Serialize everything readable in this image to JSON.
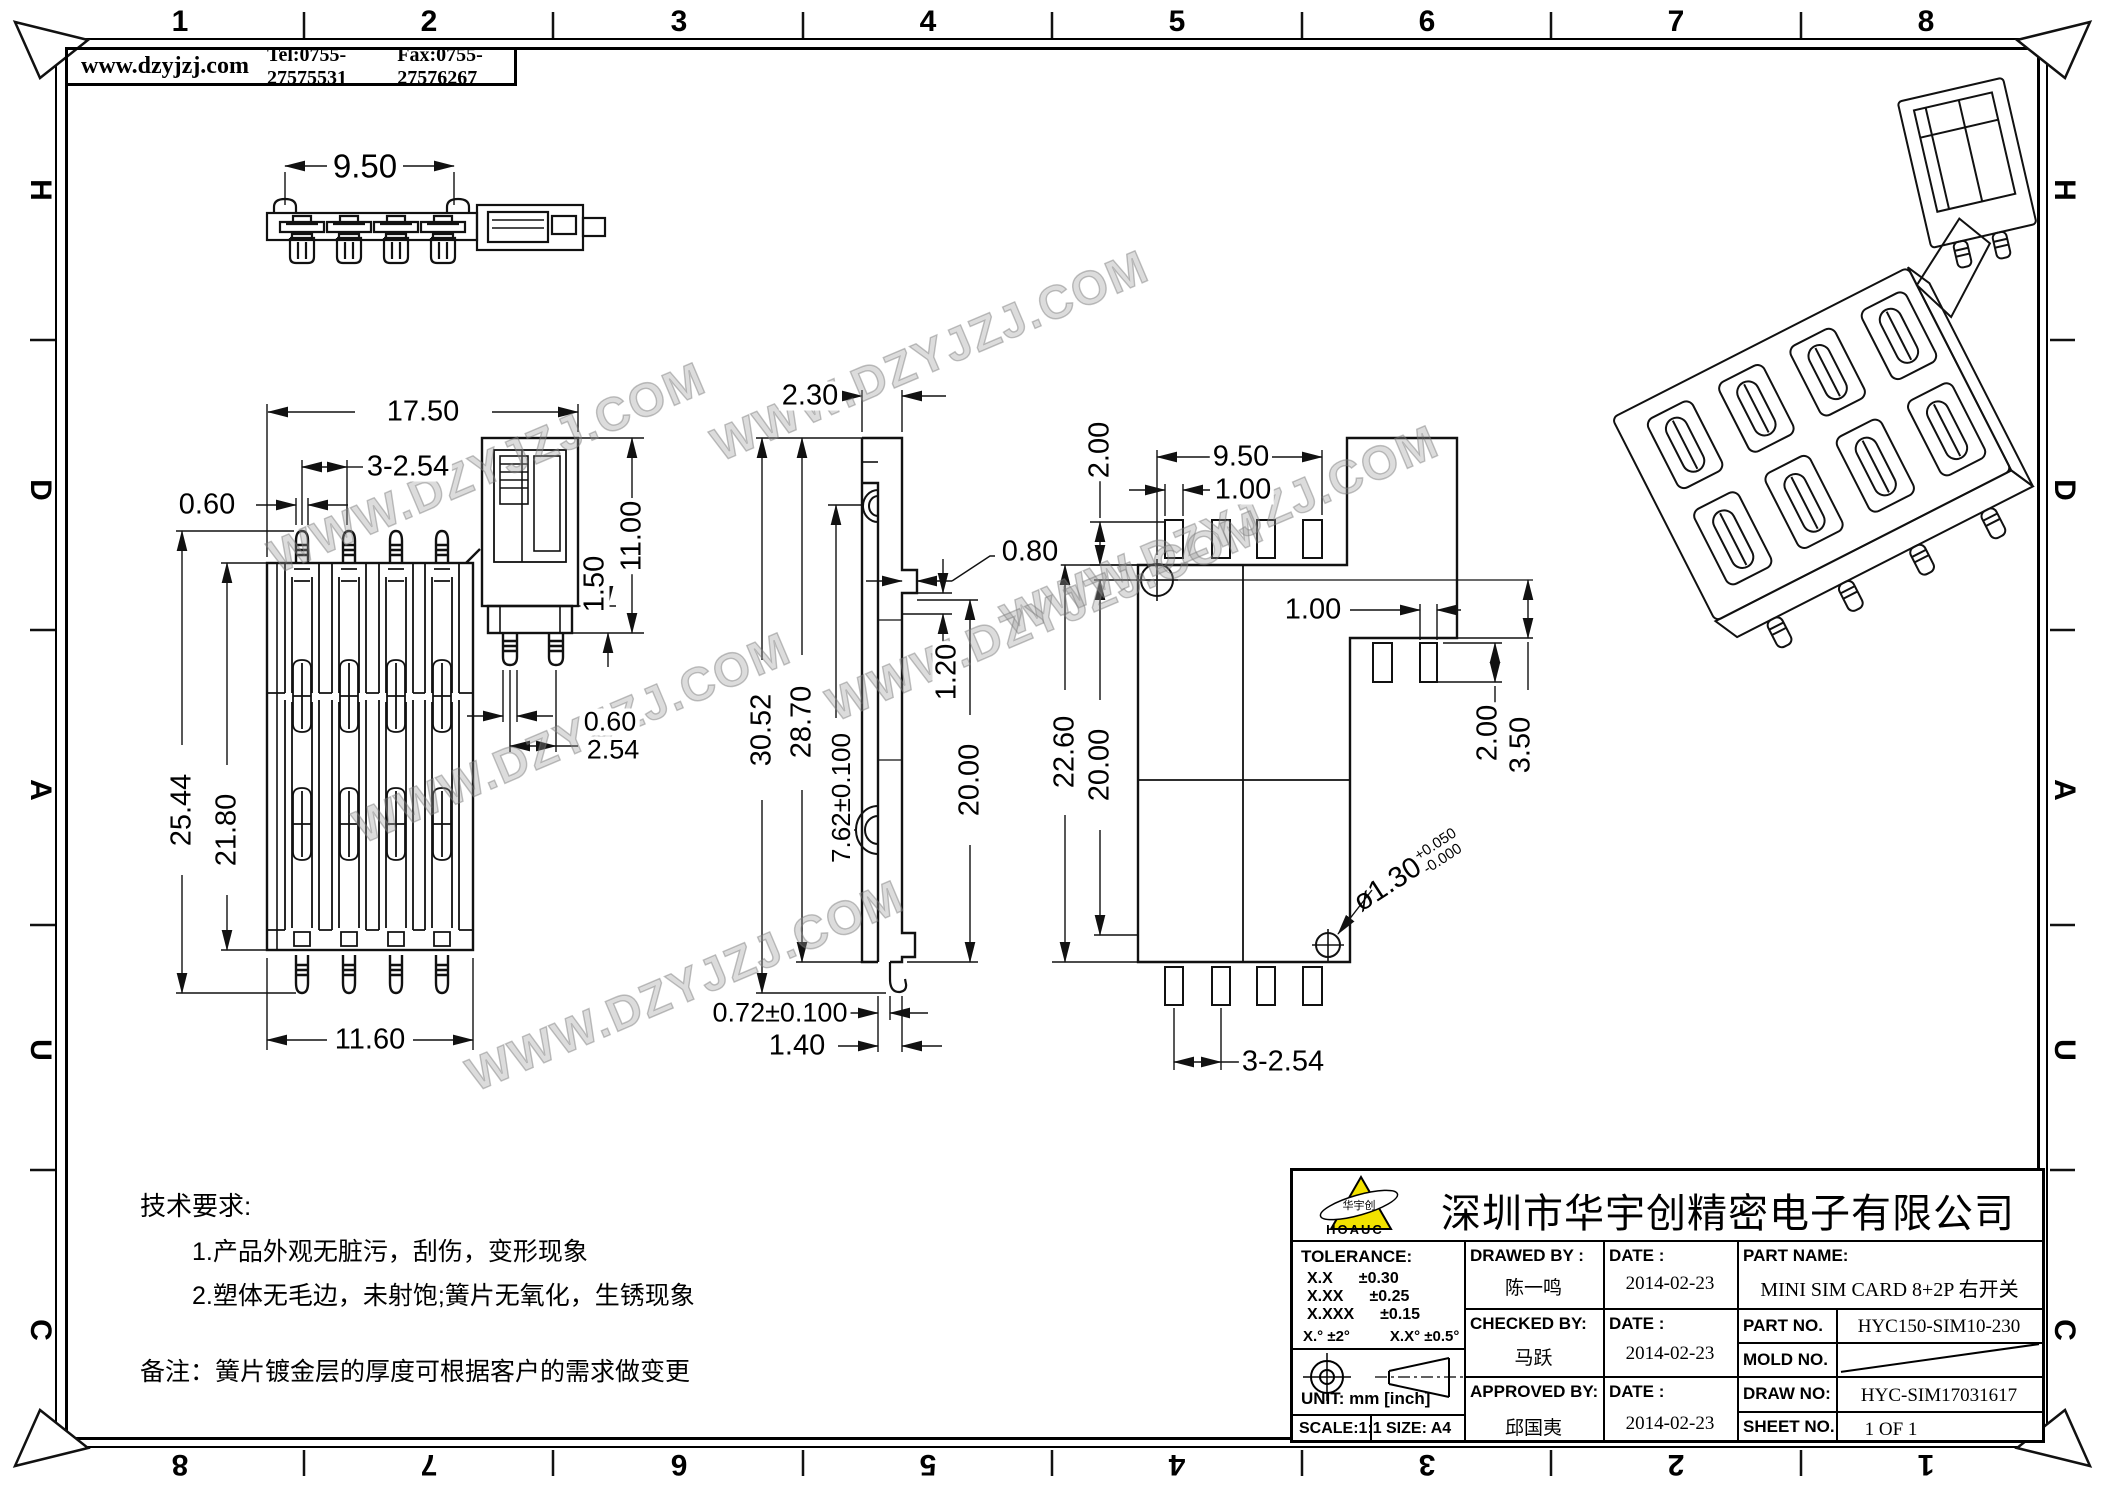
{
  "header": {
    "website": "www.dzyjzj.com",
    "tel": "Tel:0755-27575531",
    "fax": "Fax:0755-27576267"
  },
  "border": {
    "top": [
      "1",
      "2",
      "3",
      "4",
      "5",
      "6",
      "7",
      "8"
    ],
    "bottom": [
      "8",
      "7",
      "6",
      "5",
      "4",
      "3",
      "2",
      "1"
    ],
    "left": [
      "H",
      "D",
      "A",
      "U",
      "C"
    ],
    "right": [
      "H",
      "D",
      "A",
      "U",
      "C"
    ]
  },
  "watermark": "WWW.DZYJZJ.COM",
  "notes": {
    "title": "技术要求:",
    "items": [
      "1.产品外观无脏污，刮伤，变形现象",
      "2.塑体无毛边，未射饱;簧片无氧化，生锈现象"
    ],
    "remark": "备注：簧片镀金层的厚度可根据客户的需求做变更"
  },
  "dims": {
    "top_view": {
      "w950": "9.50"
    },
    "front": {
      "w1750": "17.50",
      "p3254": "3-2.54",
      "w060": "0.60",
      "h2544": "25.44",
      "h2180": "21.80",
      "h1100": "11.00",
      "h150": "1.50",
      "w060b": "0.60",
      "w254": "2.54",
      "w1160": "11.60"
    },
    "side": {
      "w230": "2.30",
      "w080": "0.80",
      "h120": "1.20",
      "h3052": "30.52",
      "h2870": "28.70",
      "h762": "7.62±0.100",
      "h2000": "20.00",
      "w072": "0.72±0.100",
      "w140": "1.40"
    },
    "footprint": {
      "h200l": "2.00",
      "w950": "9.50",
      "w100": "1.00",
      "h2260": "22.60",
      "h2000": "20.00",
      "w100r": "1.00",
      "h200r": "2.00",
      "h350": "3.50",
      "hole": "ø1.30",
      "hole_plus": "+0.050",
      "hole_minus": "-0.000",
      "p3254": "3-2.54"
    }
  },
  "titleblock": {
    "company": "深圳市华宇创精密电子有限公司",
    "logo": {
      "text": "HOAUC",
      "inner": "华宇创"
    },
    "tolerance": {
      "label": "TOLERANCE:",
      "rows": [
        [
          "X.X",
          "±0.30"
        ],
        [
          "X.XX",
          "±0.25"
        ],
        [
          "X.XXX",
          "±0.15"
        ]
      ],
      "ang1": "X.°  ±2°",
      "ang2": "X.X°  ±0.5°",
      "unit": "UNIT:  mm  [inch]",
      "scale": "SCALE:1:1",
      "size": "SIZE:  A4"
    },
    "people": [
      {
        "role": "DRAWED BY :",
        "name": "陈一鸣",
        "date_label": "DATE :",
        "date": "2014-02-23"
      },
      {
        "role": "CHECKED BY:",
        "name": "马跃",
        "date_label": "DATE :",
        "date": "2014-02-23"
      },
      {
        "role": "APPROVED BY:",
        "name": "邱国夷",
        "date_label": "DATE :",
        "date": "2014-02-23"
      }
    ],
    "part": {
      "name_label": "PART NAME:",
      "name": "MINI SIM CARD 8+2P 右开关",
      "no_label": "PART NO.",
      "no": "HYC150-SIM10-230",
      "mold_label": "MOLD NO.",
      "draw_label": "DRAW NO:",
      "draw": "HYC-SIM17031617",
      "sheet_label": "SHEET NO.",
      "sheet": "1 OF 1"
    }
  }
}
